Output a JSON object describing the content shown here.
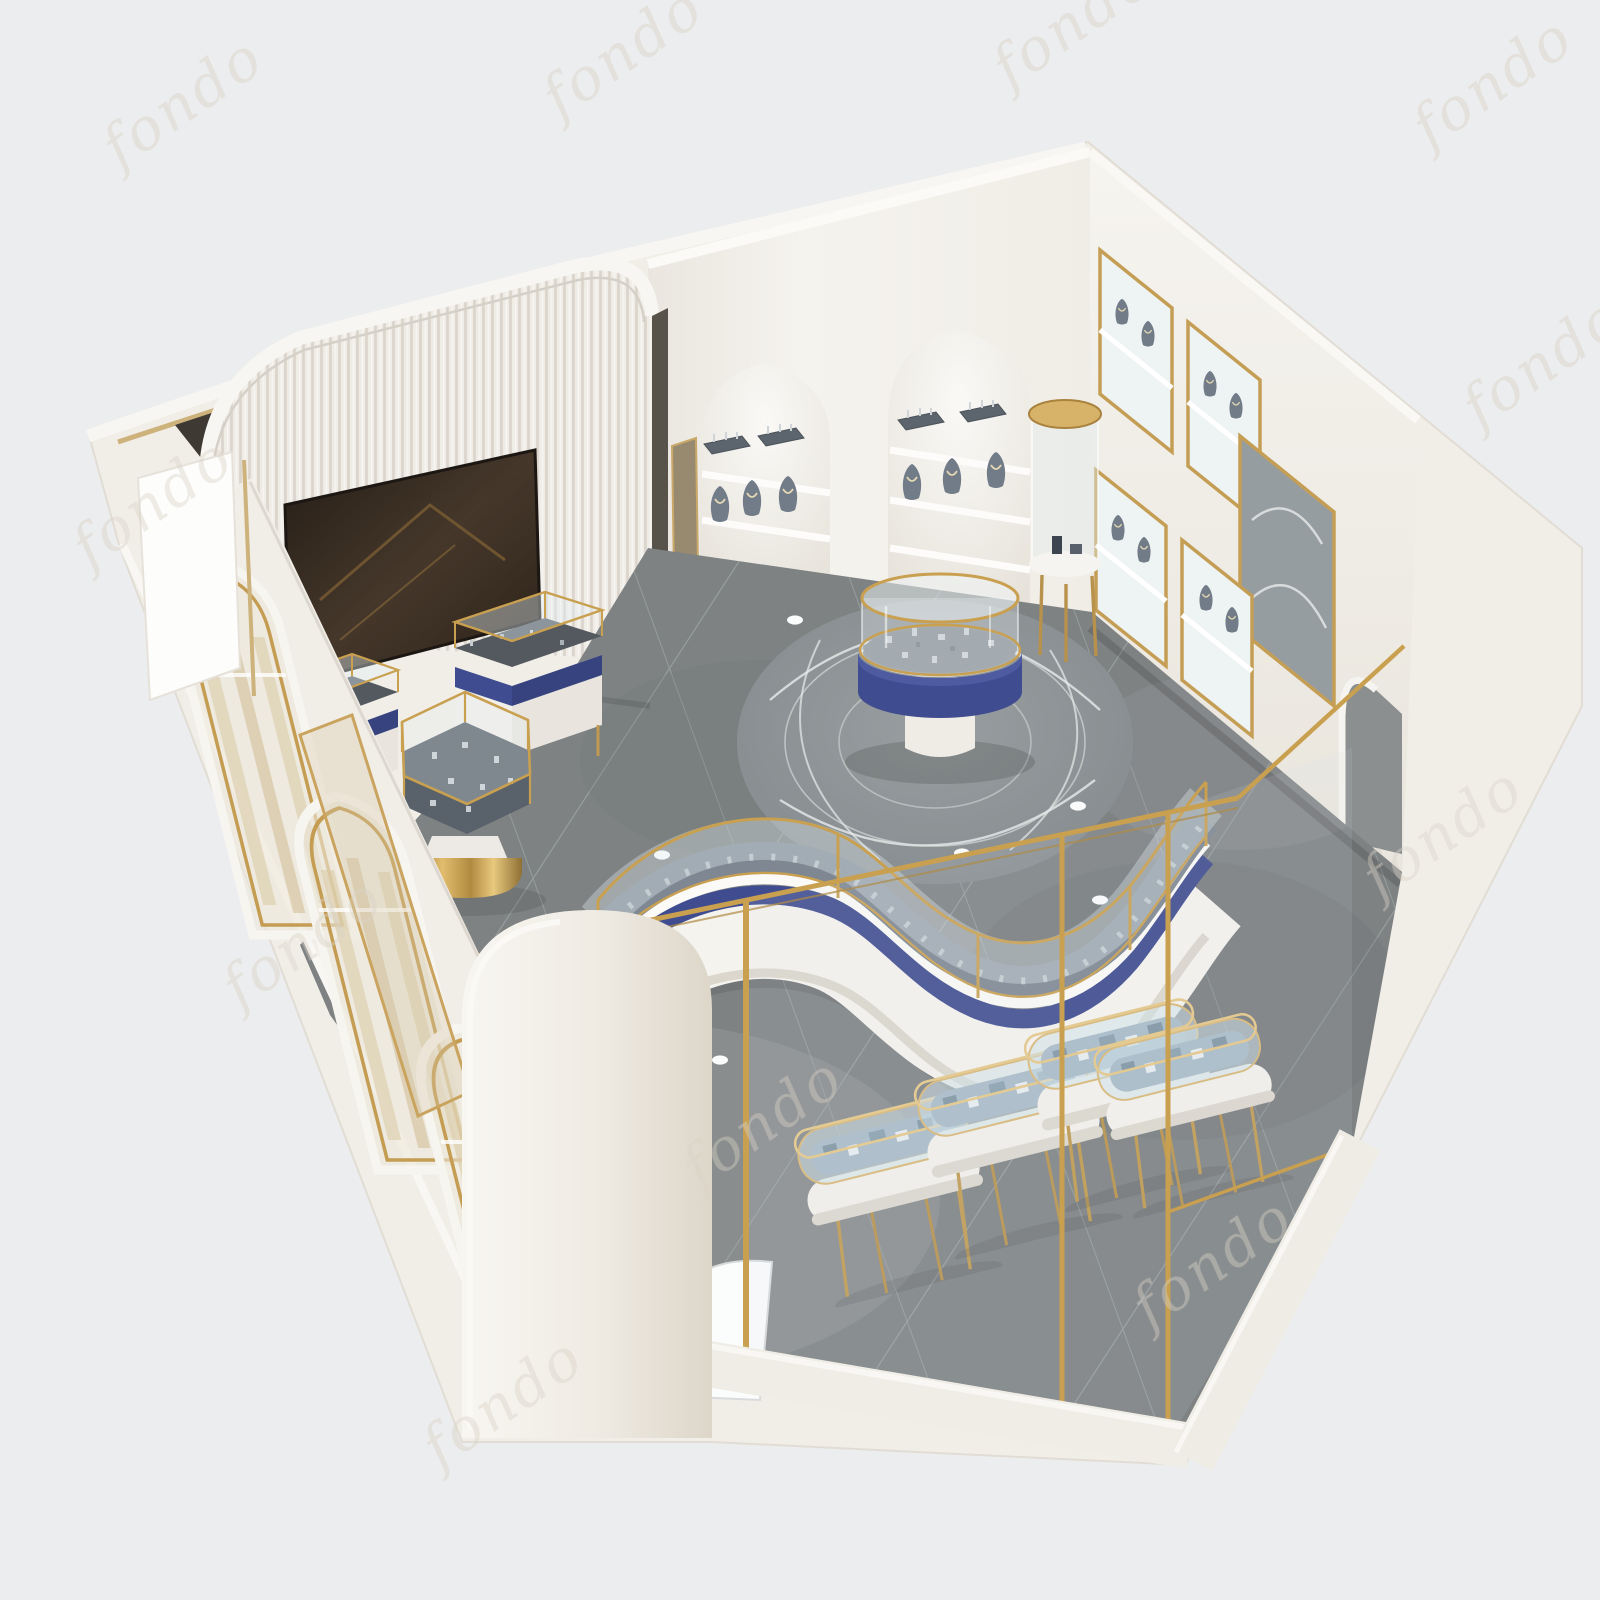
{
  "meta": {
    "subject": "3D isometric cutaway render of a luxury jewelry shop interior",
    "style": "cream and white walls with gold trim, navy blue counter accents, dark gray tile floor"
  },
  "watermark": {
    "text": "fondo",
    "color": "#d8d1c5"
  },
  "palette": {
    "background": "#ecedee",
    "building_shell": "#f1eee8",
    "wall_face": "#f4f2ed",
    "fluted_panel": "#efece6",
    "floor_tile": "#7e8283",
    "floor_grout": "#9aa0a1",
    "carpet": "#8e9396",
    "carpet_pattern": "#e9ebeb",
    "gold": "#c9a050",
    "gold_deep": "#a9823d",
    "navy": "#3f4c8f",
    "navy_dark": "#36437f",
    "counter_white": "#f5f3ee",
    "display_deck": "#7f8892",
    "oval_deck": "#a9bcc8",
    "glass_tint": "#dce8ec",
    "screen_dark": "#2e251d",
    "bust_gray": "#717c88",
    "shelf_white": "#fdfcfa"
  },
  "scene": {
    "objects": [
      "fluted-feature-wall",
      "media-screen",
      "arched-niche-shelves",
      "jewelry-busts",
      "display-trays",
      "right-wall-cabinets",
      "wall-mirror",
      "arch-opening",
      "gold-pedestal-vitrine",
      "hexagonal-display-table",
      "rectangular-counters",
      "central-round-vitrine",
      "circular-carpet",
      "s-curve-counter-run",
      "oval-display-cases",
      "glass-partitions",
      "storefront-arched-windows",
      "entrance-column",
      "round-floor-mat",
      "tile-floor"
    ]
  }
}
